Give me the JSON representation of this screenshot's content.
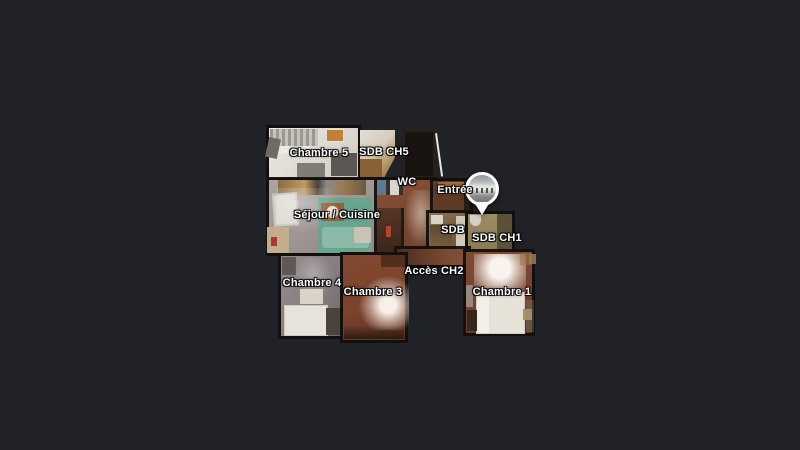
{
  "floorplan": {
    "labels": {
      "chambre5": "Chambre 5",
      "sdb_ch5": "SDB CH5",
      "wc": "WC",
      "entree": "Entrée",
      "sejour_cuisine": "Séjour / Cuisine",
      "sdb": "SDB",
      "sdb_ch1": "SDB CH1",
      "acces_ch2": "Accès CH2",
      "chambre4": "Chambre 4",
      "chambre3": "Chambre 3",
      "chambre1": "Chambre 1"
    },
    "colors": {
      "canvas_background": "#202227",
      "wall": "#121009",
      "label_text": "#ffffff",
      "wood_floor": "#7b4a31",
      "light_room_floor": "#e4e1db",
      "sejour_floor": "#a39a97",
      "teal_sofa": "#8cbaa9",
      "chambre4_floor": "#8a7f80",
      "pin_border": "#ffffff"
    },
    "icons": {
      "pin": "location-pin"
    }
  }
}
